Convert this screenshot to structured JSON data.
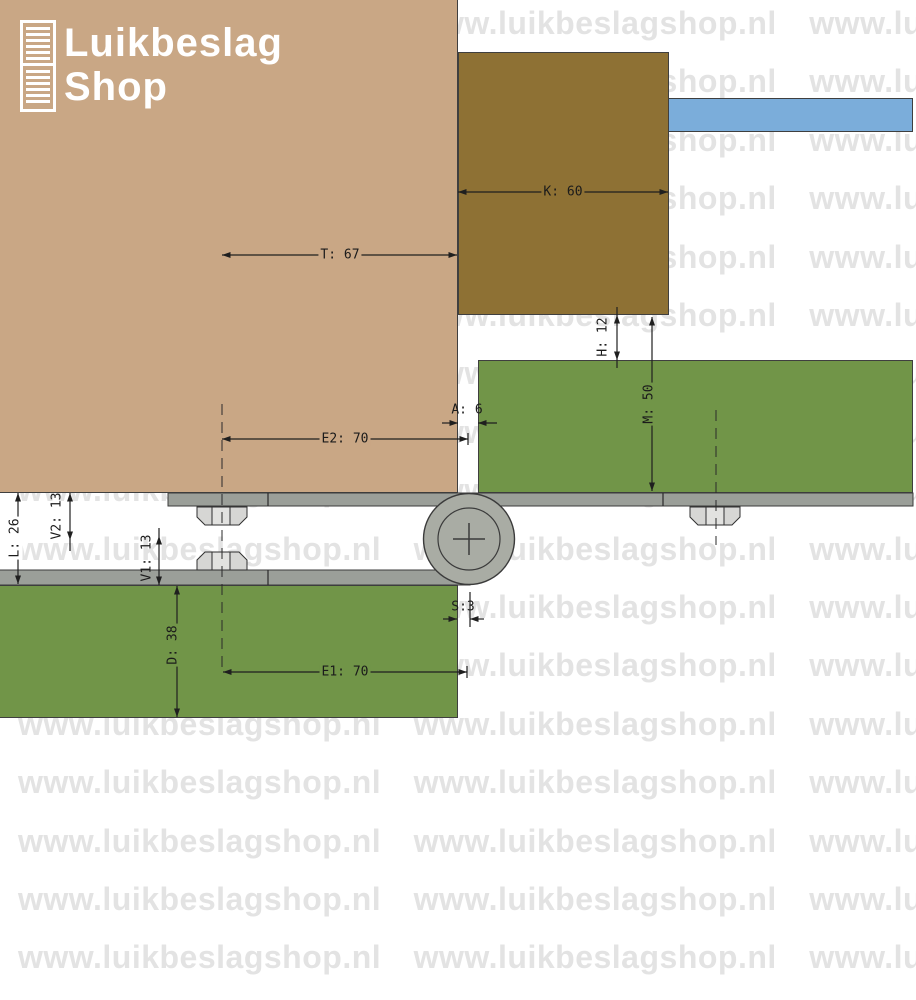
{
  "logo": {
    "brand_line1": "Luikbeslag",
    "brand_line2": "Shop"
  },
  "watermark": {
    "text": "www.luikbeslagshop.nl"
  },
  "dims": {
    "T": "T: 67",
    "K": "K: 60",
    "H": "H: 12",
    "M": "M: 50",
    "A": "A: 6",
    "E2": "E2: 70",
    "L": "L: 26",
    "V2": "V2: 13",
    "V1": "V1: 13",
    "D": "D: 38",
    "S": "S:3",
    "E1": "E1: 70"
  },
  "colors": {
    "frame_tan": "#c9a785",
    "beam_brown": "#8e7134",
    "anchor_blue": "#7badda",
    "shutter_green": "#719548",
    "hinge_plate_gray": "#9b9f99",
    "knuckle_gray": "#a9aca4",
    "nut_gray": "#d6d6d4",
    "outline": "#3f3f3f",
    "watermark_gray": "#e3e3e3"
  }
}
